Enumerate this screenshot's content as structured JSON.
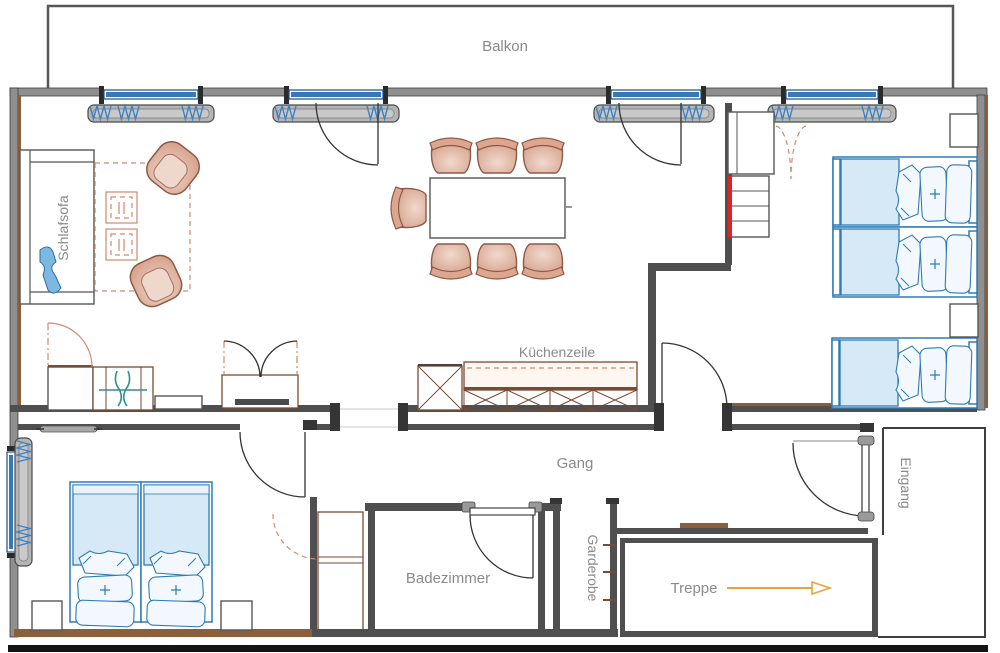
{
  "title": "Apartment floor plan",
  "labels": {
    "balcony": "Balkon",
    "sleep_sofa": "Schlafsofa",
    "kitchenette": "Küchenzeile",
    "hallway": "Gang",
    "bathroom": "Badezimmer",
    "cloakroom": "Garderobe",
    "stairs": "Treppe",
    "entrance": "Eingang"
  },
  "stairs_arrow_direction": "right",
  "palette": {
    "wall": "#4f4f4f",
    "wall_fill": "#8f8f8f",
    "wood_accent": "#8b5e3c",
    "furniture_salmon": "#cf8a70",
    "bed_blue": "#2e7bb5",
    "bed_blue_fill": "#d6e9f7",
    "blanket_blue": "#7db8e0",
    "red_accent": "#e02424",
    "teal_accent": "#2e8f8f",
    "sill_gray": "#b5b5b5",
    "label_gray": "#8a8a8a",
    "arrow_orange": "#e8a33d",
    "border_black": "#151515"
  }
}
